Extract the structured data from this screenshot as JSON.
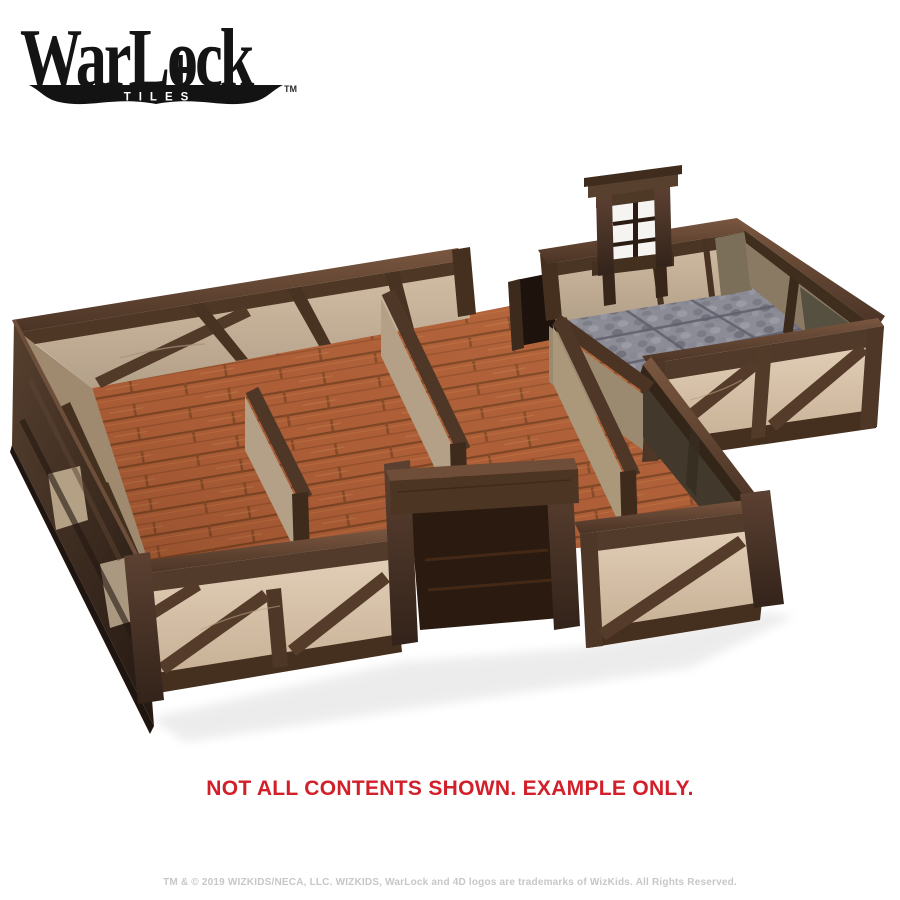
{
  "brand": {
    "name_pre": "WarL",
    "name_o": "o",
    "name_post": "ck",
    "sub": "TILES",
    "trademark": "TM"
  },
  "disclaimer": {
    "text": "NOT ALL CONTENTS SHOWN. EXAMPLE ONLY."
  },
  "legal": {
    "text": "TM & © 2019 WIZKIDS/NECA, LLC. WIZKIDS, WarLock and 4D logos are trademarks of WizKids. All Rights Reserved."
  },
  "colors": {
    "logo_black": "#141414",
    "disclaimer_red": "#d2202a",
    "legal_gray": "#c7c7c7",
    "timber_brown": "#4e362a",
    "plaster_cream": "#d9c5ae",
    "partition_tan": "#b3a086",
    "wood_floor_orange": "#b06039",
    "stone_floor_gray": "#8c8c96",
    "background": "#ffffff"
  },
  "scene": {
    "parts": [
      "timber-frame-walls",
      "wood-plank-floor",
      "stone-tile-floor",
      "window-frame-piece",
      "door-frame",
      "interior-partition-walls"
    ]
  }
}
